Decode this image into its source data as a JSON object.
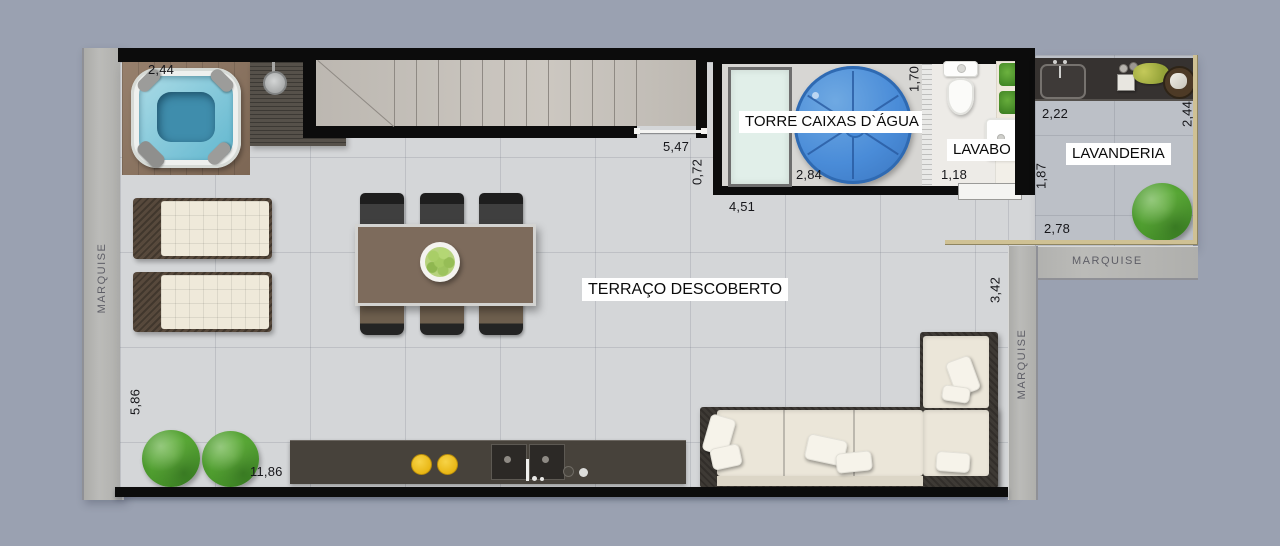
{
  "floorplan": {
    "terrace_label": "TERRAÇO DESCOBERTO",
    "water_tower_label": "TORRE CAIXAS D`ÁGUA",
    "lavatory_label": "LAVABO",
    "laundry_label": "LAVANDERIA",
    "awning_left": "MARQUISE",
    "awning_right_top": "MARQUISE",
    "awning_right_side": "MARQUISE"
  },
  "dimensions_m": {
    "hot_tub_width": "2,44",
    "shower_deck_depth": "1,06",
    "stairs_length": "5,47",
    "stairs_offset": "0,72",
    "water_tower_width": "4,51",
    "water_tank_bay_width": "2,84",
    "water_tower_depth": "1,70",
    "lavatory_width": "1,18",
    "laundry_counter_width": "2,22",
    "laundry_depth": "2,44",
    "laundry_wall_height": "1,87",
    "laundry_width": "2,78",
    "terrace_side_depth": "3,42",
    "terrace_left_depth": "5,86",
    "terrace_width": "11,86"
  },
  "colors": {
    "background": "#9aa1b1",
    "wall_black": "#0c0c0c",
    "terrace_tile": "#d4d6d8",
    "concrete_awning": "#b6b6b3",
    "wood_deck": "#8e7560",
    "tub_water_blue": "#62b7cf",
    "water_tank_blue": "#4a8cd8",
    "tank_rect_mint": "#e1efe9",
    "plant_green": "#4c9a2d",
    "pot_yellow": "#f3c41e",
    "railing_tan": "#cfc194",
    "counter_dark": "#45403a",
    "cushion_cream": "#ebe6d9"
  }
}
